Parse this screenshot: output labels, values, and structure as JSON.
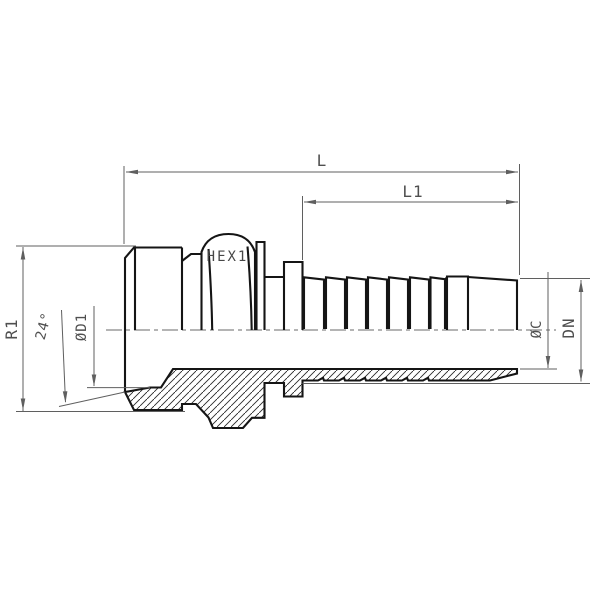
{
  "drawing": {
    "type": "technical-drawing-hose-fitting-male-stud",
    "labels": {
      "overall_length": "L",
      "tail_length": "L1",
      "hex_size": "HEX1",
      "thread_size": "R1",
      "cone_angle": "24°",
      "thread_bore_diameter": "ØD1",
      "stem_bore_diameter": "ØC",
      "nominal_diameter": "DN"
    },
    "colors": {
      "background": "#ffffff",
      "outline": "#151515",
      "dimension_lines": "#5f5f5f",
      "label_text": "#4f4f4f"
    }
  }
}
